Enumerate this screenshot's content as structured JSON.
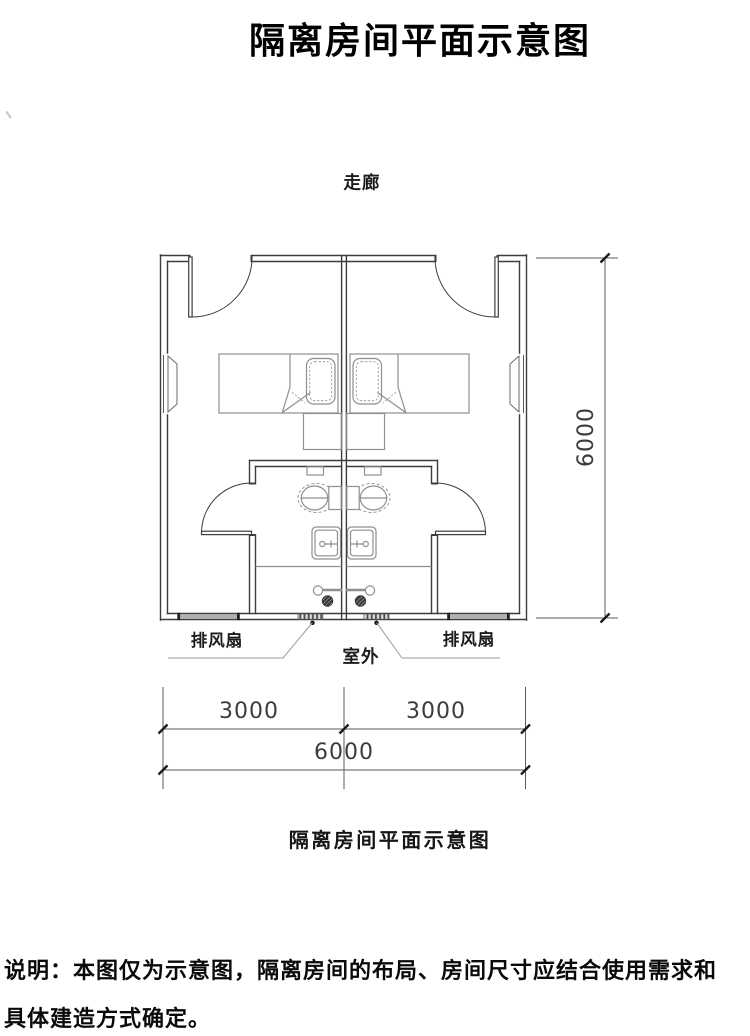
{
  "title": "隔离房间平面示意图",
  "caption": "隔离房间平面示意图",
  "note": {
    "line1": "说明：本图仅为示意图，隔离房间的布局、房间尺寸应结合使用需求和",
    "line2": "具体建造方式确定。"
  },
  "plan": {
    "corridor_label": "走廊",
    "outdoor_label": "室外",
    "exhaust_fan_left": "排风扇",
    "exhaust_fan_right": "排风扇"
  },
  "dimensions": {
    "total_height_mm": "6000",
    "left_room_width_mm": "3000",
    "right_room_width_mm": "3000",
    "total_width_mm": "6000"
  },
  "colors": {
    "wall": "#3d3d3d",
    "fixture": "#8f8f8f",
    "dimension": "#5a5a5a",
    "leader": "#9a9a9a",
    "window-fill": "#b0b0b0",
    "text": "#111111"
  }
}
